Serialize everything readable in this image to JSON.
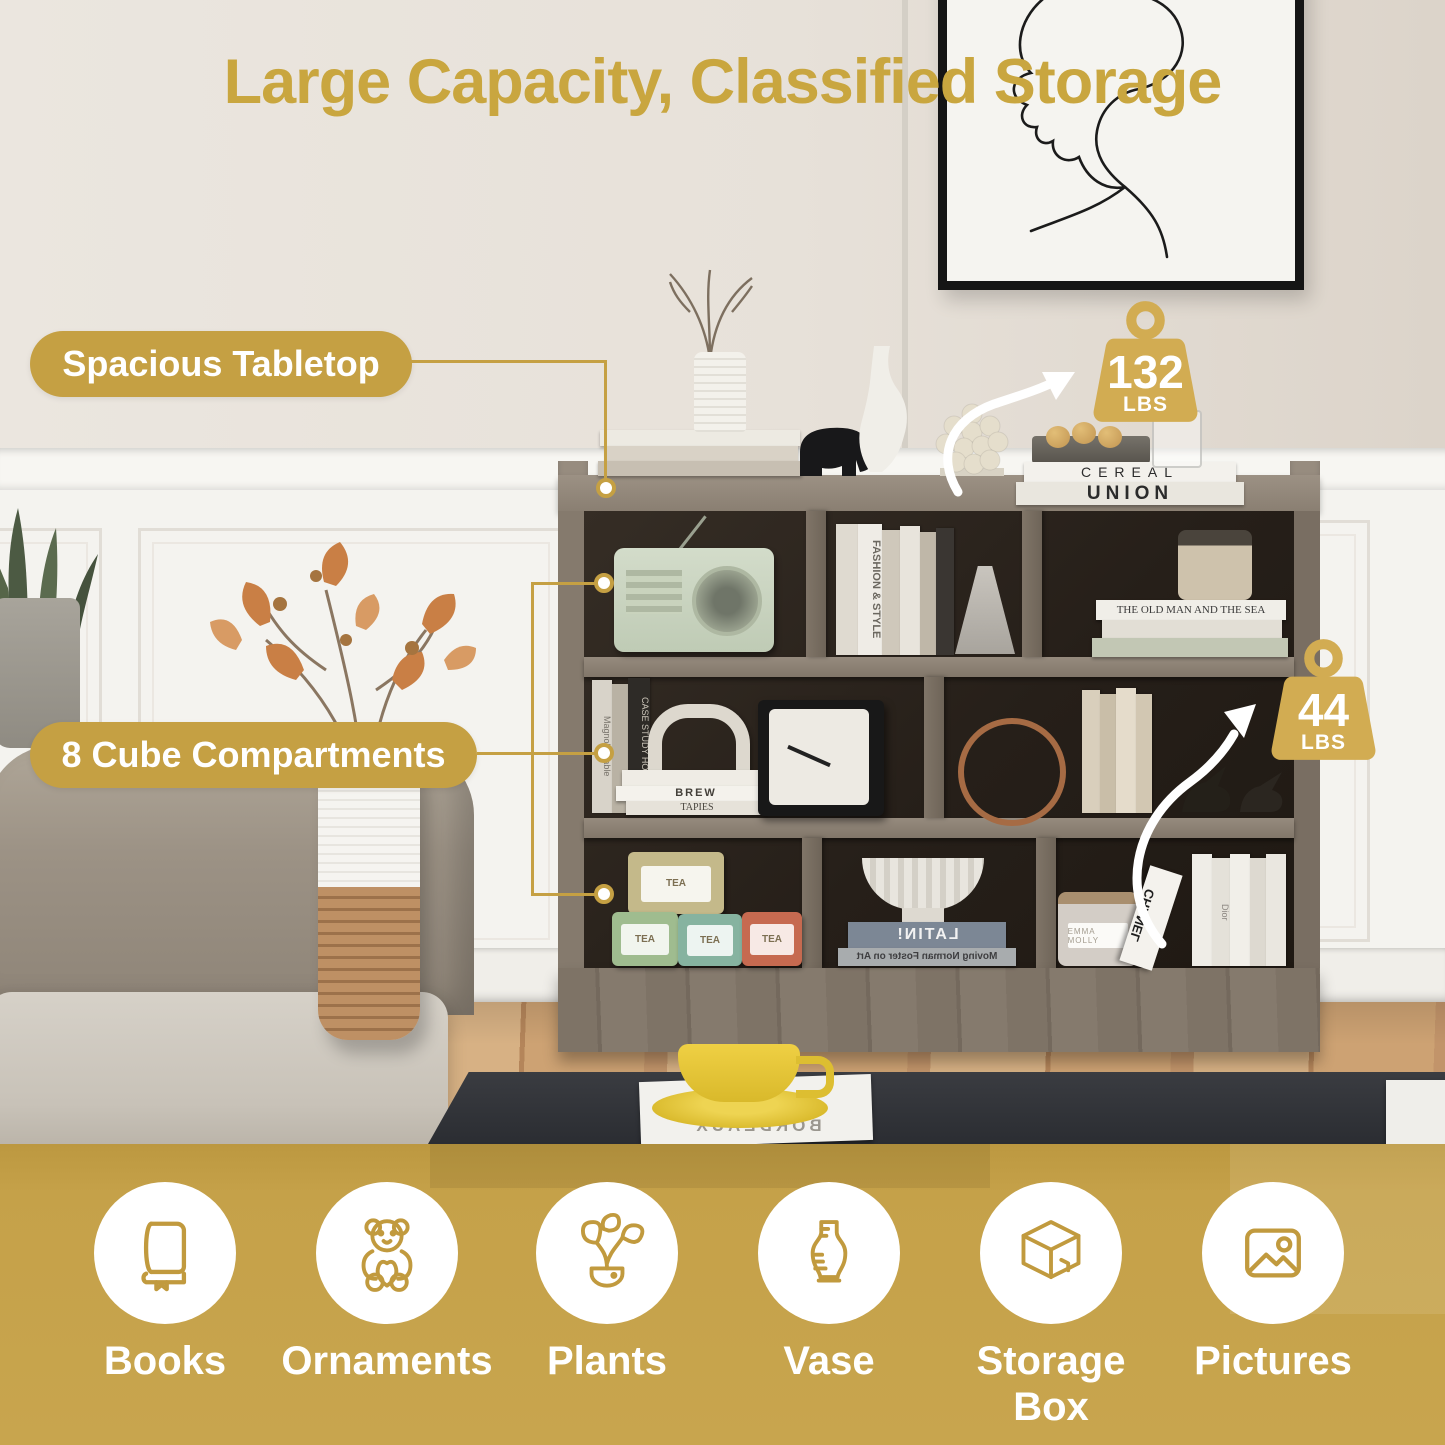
{
  "title": "Large Capacity, Classified Storage",
  "brand_colors": {
    "gold": "#C5A043",
    "badge_gold": "#D2AC52",
    "band_gold": "#C8A54E",
    "icon_gold": "#C19A3E"
  },
  "callouts": {
    "tabletop": {
      "label": "Spacious Tabletop"
    },
    "cubes": {
      "label": "8 Cube Compartments"
    }
  },
  "badges": {
    "tabletop_capacity": {
      "value": "132",
      "unit": "LBS"
    },
    "shelf_capacity": {
      "value": "44",
      "unit": "LBS"
    }
  },
  "features": [
    {
      "icon": "book-icon",
      "label": "Books"
    },
    {
      "icon": "teddy-bear-icon",
      "label": "Ornaments"
    },
    {
      "icon": "plant-icon",
      "label": "Plants"
    },
    {
      "icon": "vase-icon",
      "label": "Vase"
    },
    {
      "icon": "storage-box-icon",
      "label": "Storage Box"
    },
    {
      "icon": "picture-icon",
      "label": "Pictures"
    }
  ],
  "scene": {
    "wall_art": "abstract one-line face drawing",
    "spines": {
      "cereal": "CEREAL",
      "union": "UNION",
      "fashion_style": "FASHION & STYLE",
      "old_man": "THE OLD MAN AND THE SEA",
      "magnolia": "Magnolia Table",
      "case_study": "CASE STUDY HOUSES",
      "brew": "BREW",
      "tapies": "TAPIES",
      "latin": "LATIN!",
      "moving": "Moving Norman Foster on Art",
      "chanel": "CHANEL",
      "dior": "Dior",
      "bordeaux": "BORDEAUX",
      "emma": "EMMA MOLLY",
      "tea": "TEA"
    }
  }
}
